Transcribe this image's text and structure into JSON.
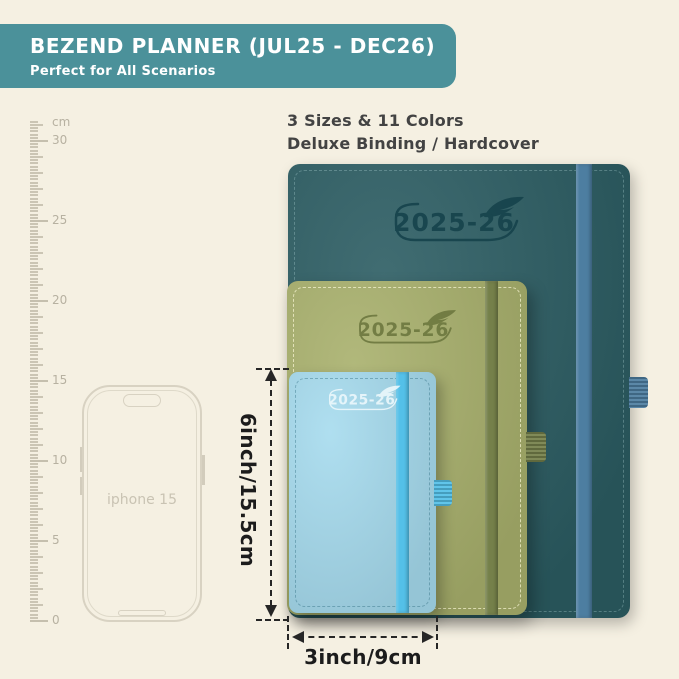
{
  "header": {
    "title": "BEZEND PLANNER (JUL25 - DEC26)",
    "subtitle": "Perfect for All Scenarios",
    "bg_color": "#4b919a"
  },
  "features": {
    "line1": "3 Sizes & 11 Colors",
    "line2": "Deluxe Binding / Hardcover"
  },
  "ruler": {
    "unit": "cm",
    "labels": [
      "30",
      "25",
      "20",
      "15",
      "10",
      "5",
      "0"
    ]
  },
  "phone": {
    "label": "iphone 15"
  },
  "planners": [
    {
      "size": "large",
      "year": "2025-26",
      "cover_color": "#2b5c62",
      "band_color": "#4d7ea1",
      "loop_color": "#4d7ea1",
      "logo_color": "#16434c"
    },
    {
      "size": "medium",
      "year": "2025-26",
      "cover_color": "#a8b06c",
      "band_color": "#75804a",
      "loop_color": "#75804a",
      "logo_color": "#6d783f"
    },
    {
      "size": "small",
      "year": "2025-26",
      "cover_color": "#a6dbee",
      "band_color": "#54c0e8",
      "loop_color": "#54c0e8",
      "logo_color": "#ecf8fc"
    }
  ],
  "dimensions": {
    "height_label": "6inch/15.5cm",
    "width_label": "3inch/9cm"
  },
  "background_color": "#f5f0e2"
}
